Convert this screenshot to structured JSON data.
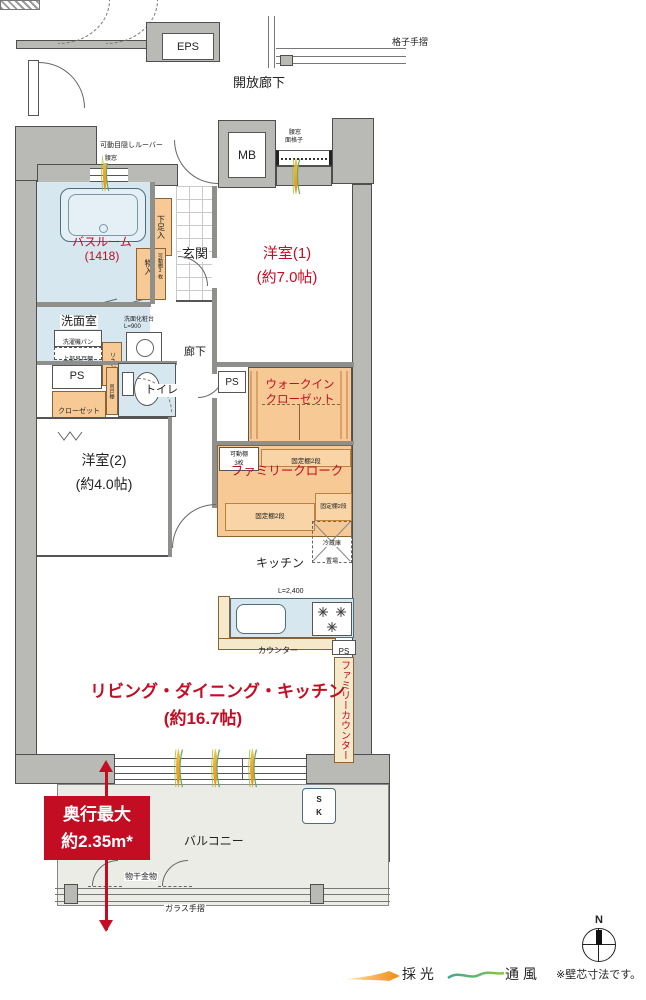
{
  "common": {
    "eps": "EPS",
    "open_corridor": "開放廊下",
    "lattice_handrail": "格子手摺",
    "mb": "MB",
    "louver": "可動目隠しルーバー",
    "bath_window": "腰窓",
    "mb_window_a": "腰窓",
    "mb_window_b": "面格子",
    "glass_handrail": "ガラス手摺",
    "drying_fixture": "物干金物"
  },
  "rooms": {
    "bathroom_name": "バスルーム",
    "bathroom_size": "(1418)",
    "western1_name": "洋室(1)",
    "western1_size": "(約7.0帖)",
    "western2_name": "洋室(2)",
    "western2_size": "(約4.0帖)",
    "washroom": "洗面室",
    "genkan": "玄関",
    "toilet": "トイレ",
    "corridor": "廊下",
    "kitchen": "キッチン",
    "ldk_name": "リビング・ダイニング・キッチン",
    "ldk_size": "(約16.7帖)",
    "balcony": "バルコニー",
    "wic_line1": "ウォークイン",
    "wic_line2": "クローゼット",
    "family_cloak": "ファミリークローク",
    "family_counter": "ファミリーカウンター"
  },
  "storage": {
    "shoe": "下足入",
    "mono_ire": "物入",
    "mono_ire_note": "可動棚3枚",
    "closet": "クローゼット",
    "movable_a": "可動棚",
    "movable_b": "3枚",
    "fixed_a": "固定棚2段",
    "fixed_b": "固定棚2段",
    "fixed_c": "固定棚2段",
    "linen": "リネン庫",
    "hang": "吊戸棚",
    "washer_pan": "洗濯機パン",
    "upper_cab": "上部吊戸棚",
    "vanity_a": "洗面化粧台",
    "vanity_b": "L=900",
    "fridge_a": "冷蔵庫",
    "fridge_b": "置場"
  },
  "kitchen": {
    "len": "L=2,400",
    "counter": "カウンター"
  },
  "ps": {
    "a": "PS",
    "b": "PS",
    "c": "PS"
  },
  "balcony": {
    "sk_s": "S",
    "sk_k": "K",
    "depth_a": "奥行最大",
    "depth_b": "約2.35m*"
  },
  "legend": {
    "daylight": "採 光",
    "ventilation": "通 風",
    "note": "※壁芯寸法です。",
    "north": "N"
  },
  "colors": {
    "wall": "#b9b9b6",
    "water_blue": "#d6e7f0",
    "storage_orange": "#f6c995",
    "counter_cream": "#f5e9cb",
    "balcony_gray": "#ecece6",
    "accent_red": "#c30d23",
    "daylight_orange": "#ef8a0c",
    "ventilation_green": "#58b06e"
  }
}
